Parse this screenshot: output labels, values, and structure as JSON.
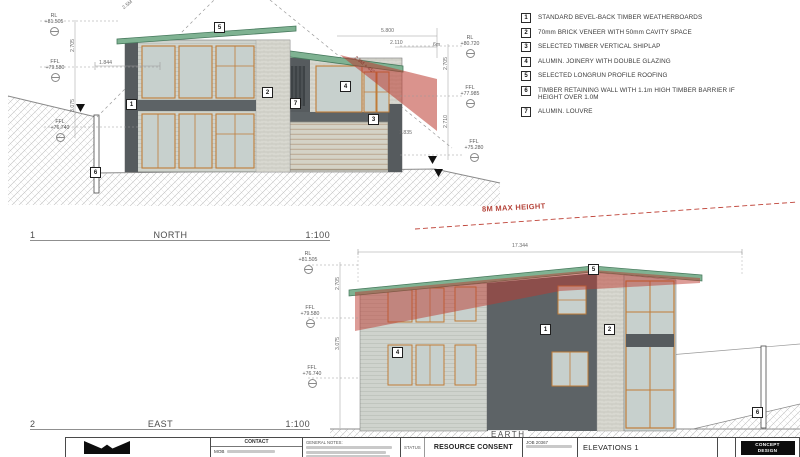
{
  "legend": {
    "items": [
      {
        "num": "1",
        "label": "STANDARD BEVEL-BACK TIMBER WEATHERBOARDS"
      },
      {
        "num": "2",
        "label": "70mm BRICK VENEER WITH 50mm CAVITY SPACE"
      },
      {
        "num": "3",
        "label": "SELECTED TIMBER VERTICAL SHIPLAP"
      },
      {
        "num": "4",
        "label": "ALUMIN. JOINERY WITH DOUBLE GLAZING"
      },
      {
        "num": "5",
        "label": "SELECTED  LONGRUN  PROFILE ROOFING"
      },
      {
        "num": "6",
        "label": "TIMBER RETAINING WALL WITH 1.1m HIGH TIMBER BARRIER IF HEIGHT OVER 1.0M"
      },
      {
        "num": "7",
        "label": "ALUMIN. LOUVRE"
      }
    ]
  },
  "markers": {
    "1": "1",
    "2": "2",
    "3": "3",
    "4": "4",
    "5": "5",
    "6": "6",
    "7": "7"
  },
  "north": {
    "number": "1",
    "title": "NORTH",
    "scale": "1:100",
    "levels_left": [
      {
        "label": "RL",
        "value": "+81.505"
      },
      {
        "label": "FFL",
        "value": "+79.580"
      },
      {
        "label": "FFL",
        "value": "+76.740"
      }
    ],
    "levels_right": [
      {
        "label": "RL",
        "value": "+80.720"
      },
      {
        "label": "FFL",
        "value": "+77.985"
      },
      {
        "label": "FFL",
        "value": "+75.280"
      }
    ],
    "dims": {
      "left_upper": "2.705",
      "left_lower": "3.075",
      "offset": "1.844",
      "top_a": "5.800",
      "top_b": "2.110",
      "top_c": "6m",
      "mid": "1.835",
      "right_upper": "2.705",
      "right_lower": "2.710"
    }
  },
  "east": {
    "number": "2",
    "title": "EAST",
    "scale": "1:100",
    "levels": [
      {
        "label": "RL",
        "value": "+81.505"
      },
      {
        "label": "FFL",
        "value": "+79.580"
      },
      {
        "label": "FFL",
        "value": "+76.740"
      }
    ],
    "dims": {
      "width": "17.344",
      "upper": "2.705",
      "lower": "3.075"
    }
  },
  "annotations": {
    "max_height": "8M MAX HEIGHT",
    "plane_label": "2.5M + 45°",
    "boundary_label": "2.5M",
    "earth": "EARTH"
  },
  "titleblock": {
    "contact_label": "CONTACT",
    "mob_label": "MOB",
    "notes_header": "GENERAL NOTES:",
    "status_label": "STATUS",
    "status_value": "RESOURCE CONSENT",
    "job_label": "JOB",
    "job_number": "20367",
    "sheet_title": "ELEVATIONS 1",
    "badge_line1": "CONCEPT",
    "badge_line2": "DESIGN"
  }
}
